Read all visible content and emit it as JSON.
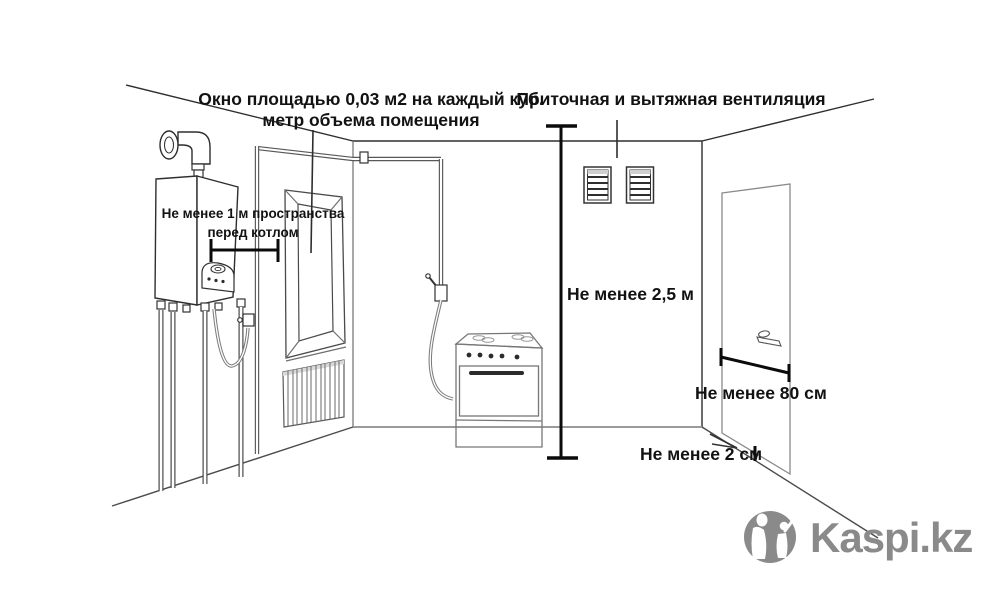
{
  "canvas": {
    "width": 1000,
    "height": 600,
    "background": "#ffffff"
  },
  "palette": {
    "line_dark": "#2e2e2e",
    "line_gray": "#9a9a9a",
    "dimension_black": "#0b0b0b",
    "text_color": "#121212",
    "logo_gray": "#8a8a8a",
    "grille_shade": "#d9d9d9"
  },
  "annotations": {
    "window_note_line1": "Окно площадью 0,03 м2 на каждый куб.",
    "window_note_line2": "метр объема помещения",
    "ventilation_note": "Приточная и вытяжная вентиляция",
    "boiler_clearance_line1": "Не менее 1 м пространства",
    "boiler_clearance_line2": "перед котлом",
    "ceiling_height": "Не менее 2,5 м",
    "door_width": "Не менее 80 см",
    "door_gap": "Не менее 2 см"
  },
  "branding": {
    "logo_text": "Kaspi.kz"
  }
}
